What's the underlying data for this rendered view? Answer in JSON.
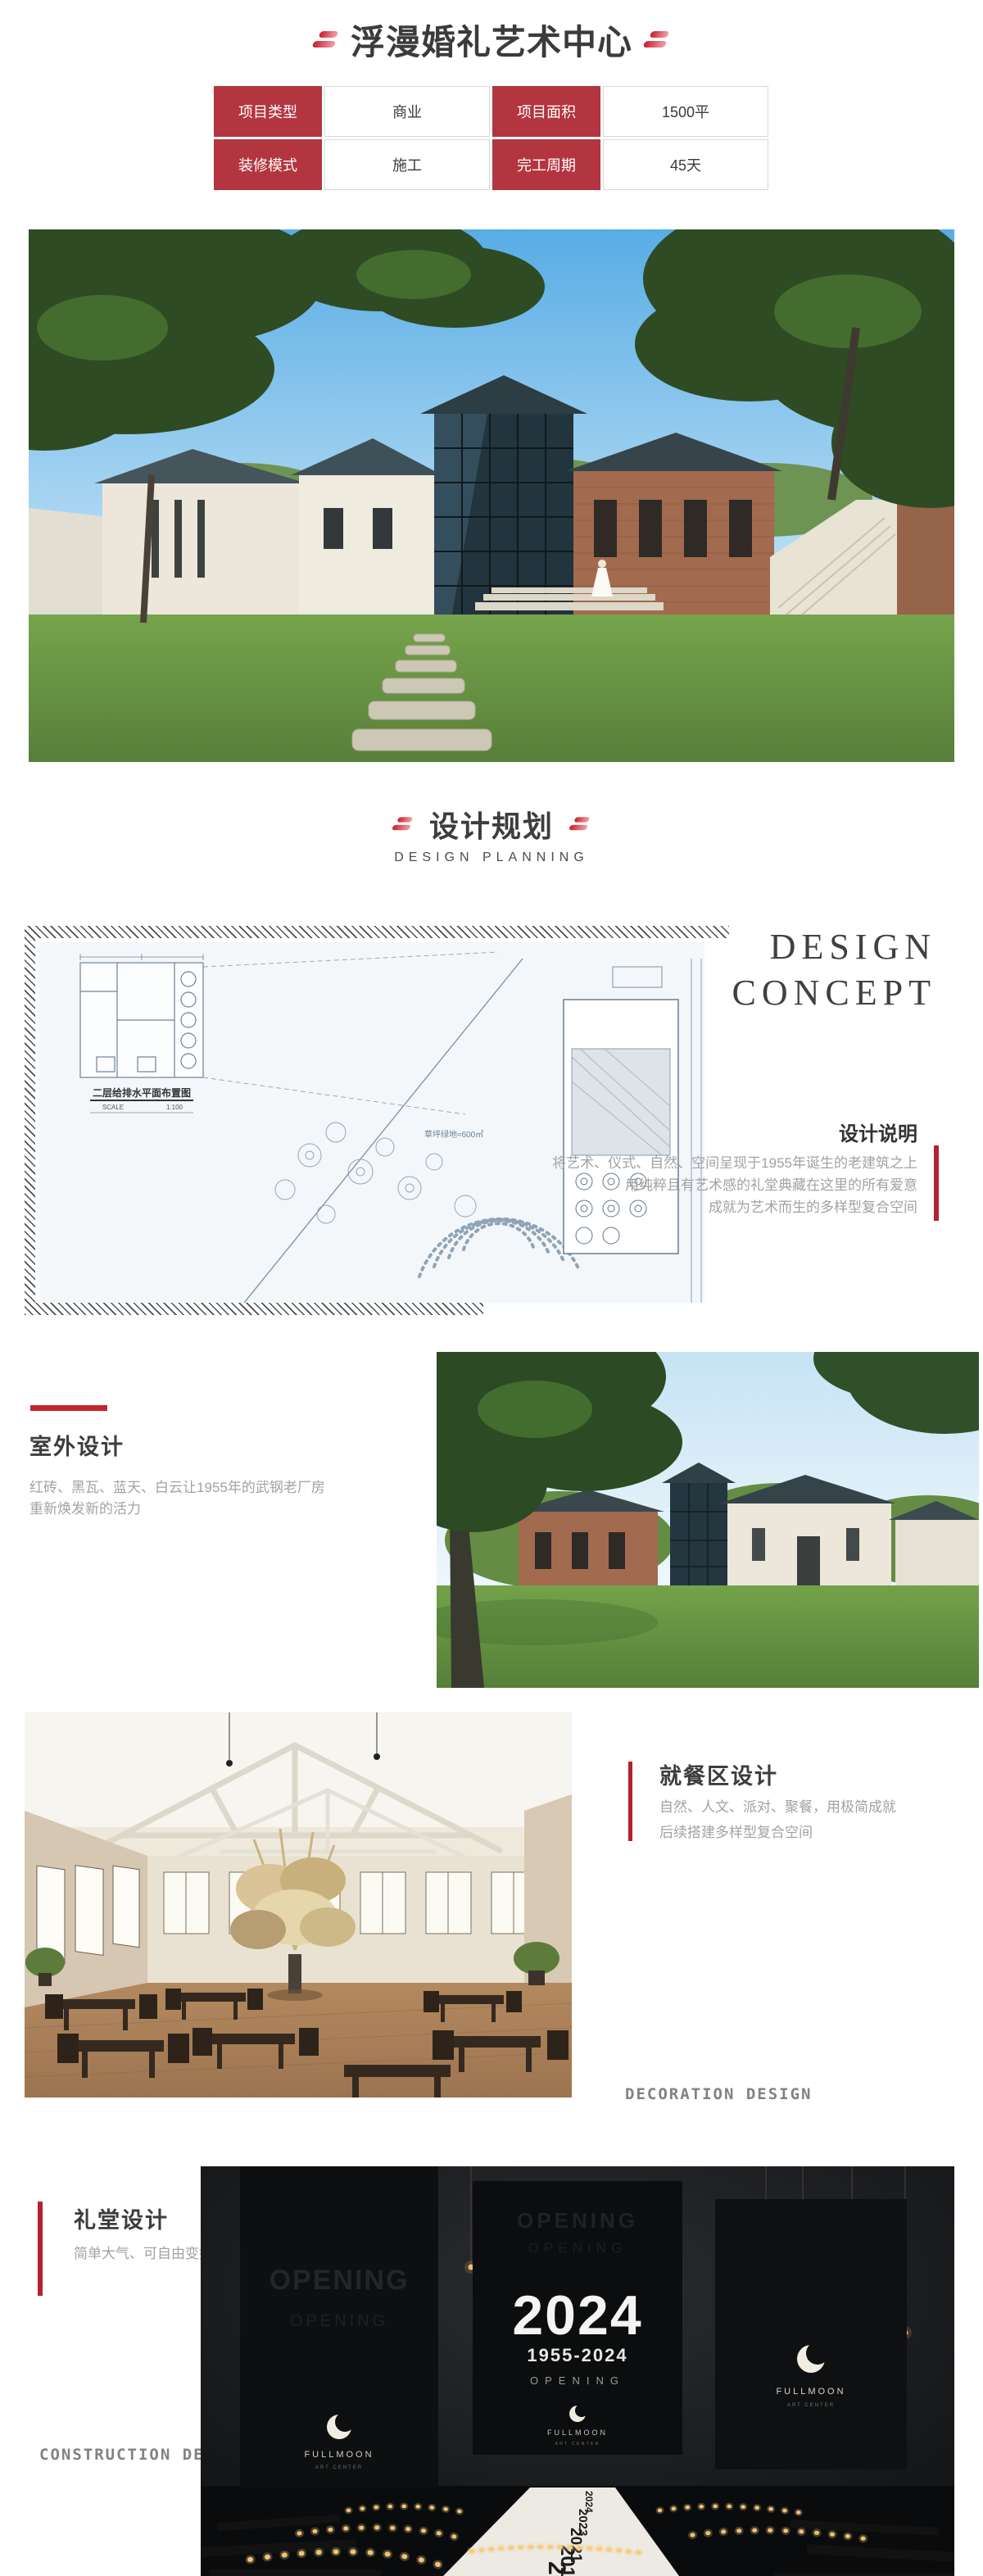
{
  "colors": {
    "accent_red": "#b23540",
    "bar_red": "#c3242f",
    "dark_text": "#3d3d3d",
    "gray_text": "#a2a2a2"
  },
  "header": {
    "title": "浮漫婚礼艺术中心",
    "info": {
      "r1c1_label": "项目类型",
      "r1c1_value": "商业",
      "r1c2_label": "项目面积",
      "r1c2_value": "1500平",
      "r2c1_label": "装修模式",
      "r2c1_value": "施工",
      "r2c2_label": "完工周期",
      "r2c2_value": "45天"
    }
  },
  "planning": {
    "title": "设计规划",
    "subtitle": "DESIGN PLANNING"
  },
  "concept": {
    "word1": "DESIGN",
    "word2": "CONCEPT",
    "label": "设计说明",
    "line1": "将艺术、仪式、自然、空间呈现于1955年诞生的老建筑之上",
    "line2": "用纯粹且有艺术感的礼堂典藏在这里的所有爱意",
    "line3": "成就为艺术而生的多样型复合空间"
  },
  "plan": {
    "caption": "二层给排水平面布置图",
    "scale_label": "SCALE",
    "scale_value": "1:100",
    "area_note": "草坪绿地≈600㎡"
  },
  "outdoor": {
    "title": "室外设计",
    "line1": "红砖、黑瓦、蓝天、白云让1955年的武钢老厂房",
    "line2": "重新焕发新的活力"
  },
  "dining": {
    "title": "就餐区设计",
    "line1": "自然、人文、派对、聚餐，用极简成就",
    "line2": "后续搭建多样型复合空间",
    "watermark": "DECORATION DESIGN"
  },
  "hall": {
    "title": "礼堂设计",
    "line1": "简单大气、可自由变换的仪式感空间",
    "watermark": "CONSTRUCTION DECORATION",
    "banner": {
      "ghost1": "OPENING",
      "ghost2": "OPENING",
      "year": "2024",
      "range": "1955-2024",
      "opening": "OPENING",
      "brand": "FULLMOON",
      "brand_sub": "ART CENTER"
    },
    "carpet_years": [
      "2024",
      "2023",
      "2021",
      "2019",
      "2018"
    ]
  }
}
